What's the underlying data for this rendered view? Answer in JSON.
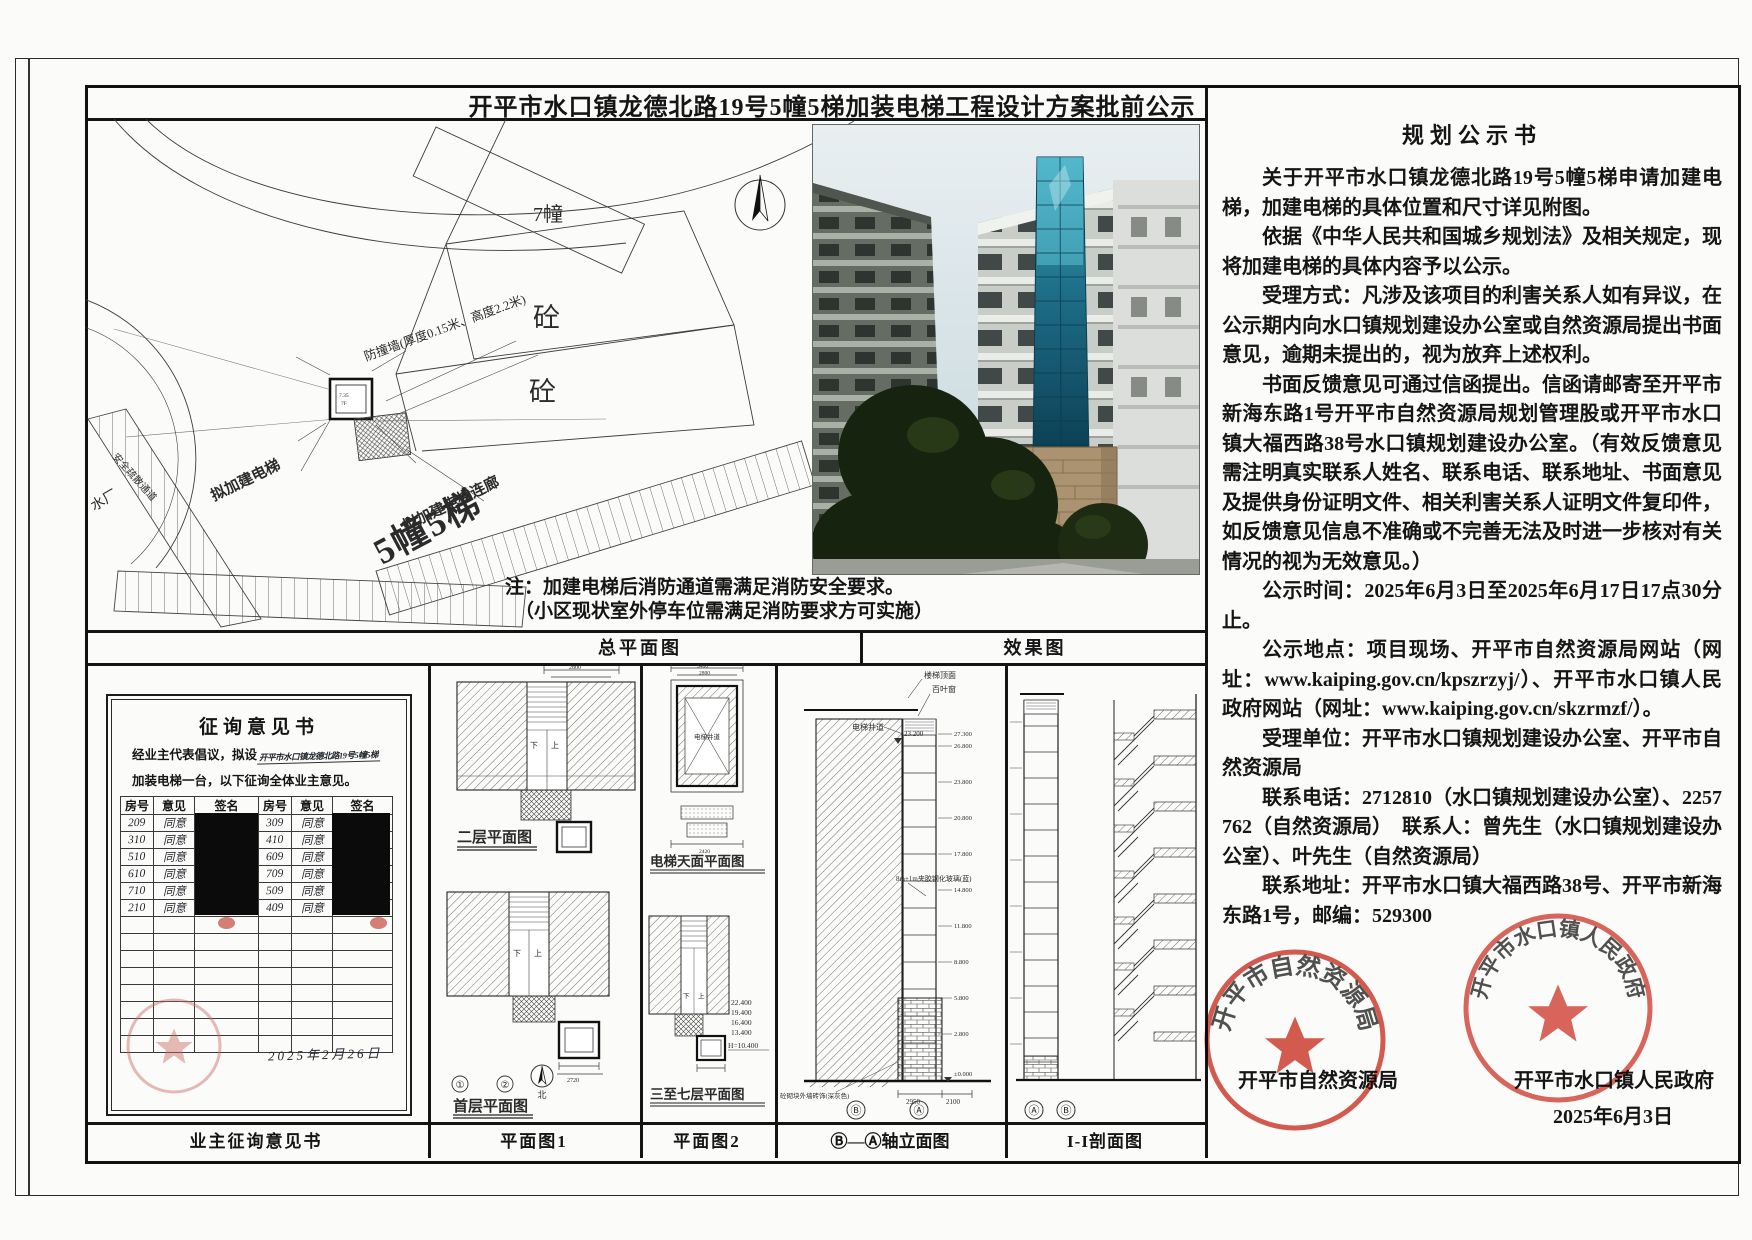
{
  "page": {
    "title": "开平市水口镇龙德北路19号5幢5梯加装电梯工程设计方案批前公示"
  },
  "site_plan": {
    "panel_label": "总平面图",
    "building7": "7幢",
    "concrete1": "砼",
    "concrete2": "砼",
    "wall_note": "防撞墙(厚度0.15米、高度2.2米)",
    "elevator_label": "拟加建电梯",
    "corridor_label": "拟加建电梯连廊",
    "building5": "5幢5梯",
    "water_plant": "水厂",
    "escape_route": "安全疏散通道",
    "detail_num1": "7.35",
    "detail_num2": "7F",
    "note_line1": "注：加建电梯后消防通道需满足消防安全要求。",
    "note_line2": "（小区现状室外停车位需满足消防要求方可实施）"
  },
  "photo": {
    "panel_label": "效果图"
  },
  "consultation": {
    "panel_label": "业主征询意见书",
    "title": "征询意见书",
    "intro_prefix": "经业主代表倡议，拟设",
    "intro_fill": "开平市水口镇龙德北路19号5幢5梯",
    "intro_line2": "加装电梯一台，以下征询全体业主意见。",
    "headers": [
      "房号",
      "意见",
      "签名",
      "房号",
      "意见",
      "签名"
    ],
    "rows": [
      [
        "209",
        "同意",
        "309",
        "同意"
      ],
      [
        "310",
        "同意",
        "410",
        "同意"
      ],
      [
        "510",
        "同意",
        "609",
        "同意"
      ],
      [
        "610",
        "同意",
        "709",
        "同意"
      ],
      [
        "710",
        "同意",
        "509",
        "同意"
      ],
      [
        "210",
        "同意",
        "409",
        "同意"
      ]
    ],
    "date": "2025年2月26日"
  },
  "plan1": {
    "panel_label": "平面图1",
    "upper_label": "二层平面图",
    "lower_label": "首层平面图",
    "axis1": "①",
    "axis2": "②",
    "north": "北",
    "up": "上",
    "down": "下",
    "dim_top": "2800",
    "dim_bottom": "2720"
  },
  "plan2": {
    "panel_label": "平面图2",
    "upper_label": "电梯天面平面图",
    "lower_label": "三至七层平面图",
    "shaft_label": "电梯井道",
    "dim1": "3400",
    "dim2": "2800",
    "dim3": "2420",
    "elevations": [
      "22.400",
      "19.400",
      "16.400",
      "13.400"
    ],
    "elevation_base": "H=10.400",
    "up": "上",
    "down": "下"
  },
  "elevation_view": {
    "panel_label": "Ⓑ—Ⓐ轴立面图",
    "roof_label": "楼梯顶面",
    "louver_label": "百叶窗",
    "shaft_label": "电梯井道",
    "top_level": "23.200",
    "glass_note": "8m+1m夹胶钢化玻璃(蓝)",
    "levels": [
      "27.300",
      "26.800",
      "23.800",
      "20.800",
      "17.800",
      "14.800",
      "11.800",
      "8.800",
      "5.800",
      "2.800"
    ],
    "ground_level": "±0.000",
    "dim1": "2950",
    "dim2": "2100",
    "axis_b": "Ⓑ",
    "axis_a": "Ⓐ",
    "finish_note": "砼砌块外墙砖饰(深灰色)"
  },
  "section_view": {
    "panel_label": "I-I剖面图",
    "axis_a": "Ⓐ",
    "axis_b": "Ⓑ"
  },
  "notice": {
    "title": "规划公示书",
    "paragraphs": [
      "关于开平市水口镇龙德北路19号5幢5梯申请加建电梯，加建电梯的具体位置和尺寸详见附图。",
      "依据《中华人民共和国城乡规划法》及相关规定，现将加建电梯的具体内容予以公示。",
      "受理方式：凡涉及该项目的利害关系人如有异议，在公示期内向水口镇规划建设办公室或自然资源局提出书面意见，逾期未提出的，视为放弃上述权利。",
      "书面反馈意见可通过信函提出。信函请邮寄至开平市新海东路1号开平市自然资源局规划管理股或开平市水口镇大福西路38号水口镇规划建设办公室。（有效反馈意见需注明真实联系人姓名、联系电话、联系地址、书面意见及提供身份证明文件、相关利害关系人证明文件复印件，如反馈意见信息不准确或不完善无法及时进一步核对有关情况的视为无效意见。）",
      "公示时间：2025年6月3日至2025年6月17日17点30分止。",
      "公示地点：项目现场、开平市自然资源局网站（网址：www.kaiping.gov.cn/kpszrzyj/）、开平市水口镇人民政府网站（网址：www.kaiping.gov.cn/skzrmzf/）。",
      "受理单位：开平市水口镇规划建设办公室、开平市自然资源局",
      "联系电话：2712810（水口镇规划建设办公室）、2257762（自然资源局）　联系人：曾先生（水口镇规划建设办公室）、叶先生（自然资源局）",
      "联系地址：开平市水口镇大福西路38号、开平市新海东路1号，邮编：529300"
    ],
    "agency_left": "开平市自然资源局",
    "agency_right": "开平市水口镇人民政府",
    "date": "2025年6月3日",
    "stamp1_text": "开平市自然资源局",
    "stamp2_text": "开平市水口镇人民政府"
  },
  "colors": {
    "stamp_red": "#cf372b",
    "redaction": "#0b0b0b",
    "glass_teal": "#2a7f9a"
  }
}
